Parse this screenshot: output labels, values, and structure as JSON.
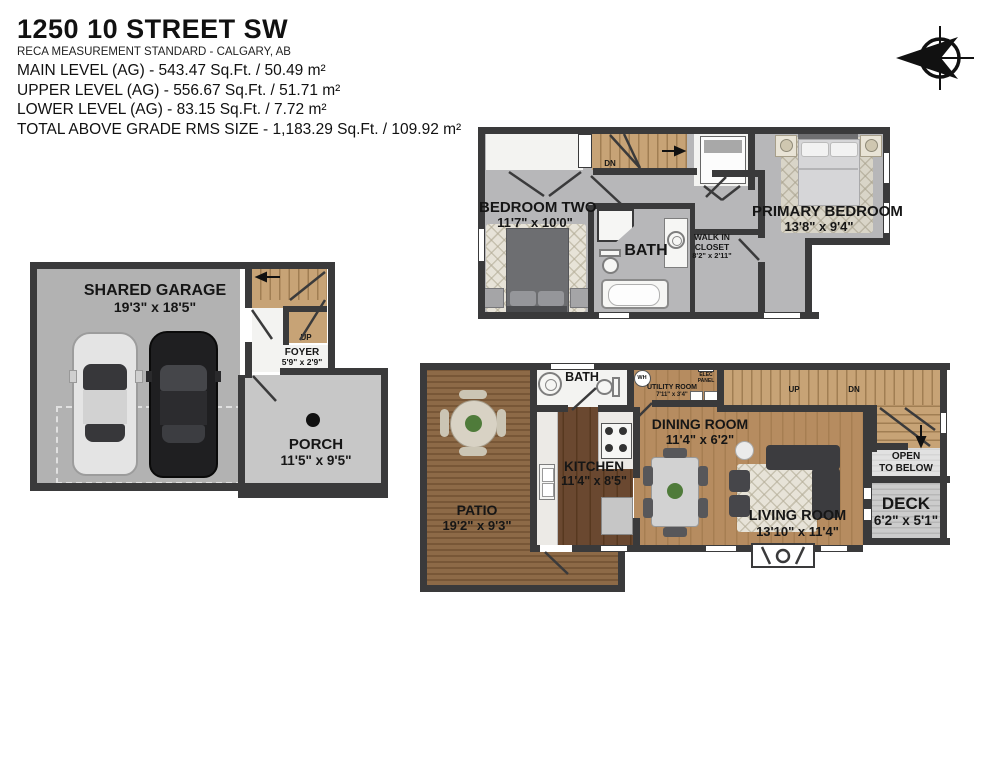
{
  "header": {
    "title": "1250 10 STREET SW",
    "subtitle": "RECA MEASUREMENT STANDARD - CALGARY, AB",
    "line1": "MAIN LEVEL (AG) - 543.47 Sq.Ft. / 50.49 m²",
    "line2": "UPPER LEVEL (AG) - 556.67 Sq.Ft. / 51.71 m²",
    "line3": "LOWER LEVEL (AG) - 83.15 Sq.Ft. / 7.72 m²",
    "line4": "TOTAL ABOVE GRADE RMS SIZE - 1,183.29 Sq.Ft. / 109.92 m²"
  },
  "upper": {
    "bedroom_two": {
      "name": "BEDROOM TWO",
      "dims": "11'7\" x 10'0\""
    },
    "bath": {
      "name": "BATH"
    },
    "closet": {
      "line1": "WALK IN",
      "line2": "CLOSET",
      "dims": "8'2\" x 2'11\""
    },
    "primary": {
      "name": "PRIMARY BEDROOM",
      "dims": "13'8\" x 9'4\""
    },
    "stairs": {
      "dn": "DN"
    }
  },
  "garage_level": {
    "garage": {
      "name": "SHARED GARAGE",
      "dims": "19'3\" x 18'5\""
    },
    "foyer": {
      "name": "FOYER",
      "dims": "5'9\" x 2'9\""
    },
    "porch": {
      "name": "PORCH",
      "dims": "11'5\" x 9'5\""
    },
    "stairs": {
      "up": "UP"
    }
  },
  "main": {
    "patio": {
      "name": "PATIO",
      "dims": "19'2\" x 9'3\""
    },
    "bath": {
      "name": "BATH"
    },
    "kitchen": {
      "name": "KITCHEN",
      "dims": "11'4\" x 8'5\""
    },
    "utility": {
      "name": "UTILITY ROOM",
      "dims": "7'11\" x 3'4\"",
      "wh": "WH",
      "elec1": "ELEC",
      "elec2": "PANEL"
    },
    "dining": {
      "name": "DINING ROOM",
      "dims": "11'4\" x 6'2\""
    },
    "living": {
      "name": "LIVING ROOM",
      "dims": "13'10\" x 11'4\""
    },
    "deck": {
      "name": "DECK",
      "dims": "6'2\" x 5'1\""
    },
    "open_below": {
      "line1": "OPEN",
      "line2": "TO BELOW"
    },
    "stairs": {
      "up": "UP",
      "dn": "DN"
    }
  },
  "colors": {
    "wall": "#3a3a3b",
    "floor_gray": "#b7b7b9",
    "porch_gray": "#c7c7c7",
    "stair_wood": "#c7a376",
    "patio_wood": "#8d6a47",
    "kitchen_wood": "#6a4830",
    "living_wood": "#b68c60",
    "deck_gray": "#cccccc",
    "text": "#161616"
  }
}
